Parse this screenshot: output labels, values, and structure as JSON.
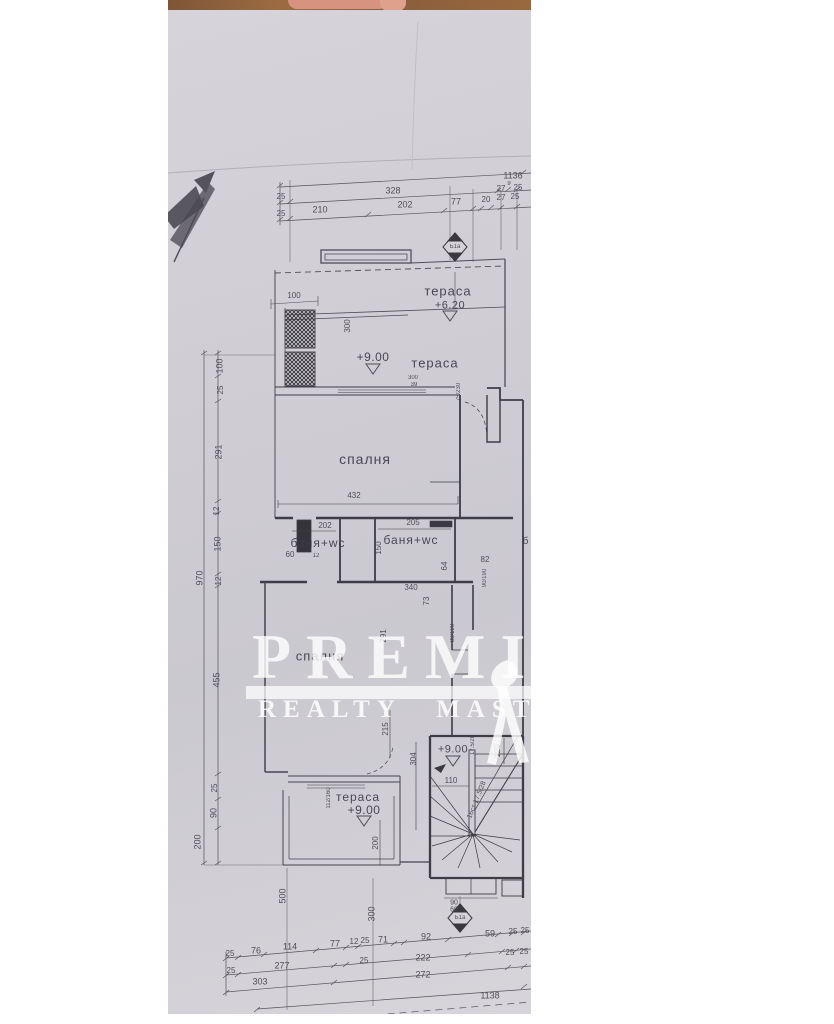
{
  "colors": {
    "page_background": "#ffffff",
    "paper": "#d2d0d6",
    "ink": "#46444c",
    "wall_ink": "#3a3940",
    "table_wood": "#8a5e3b",
    "watermark_white": "#ffffff"
  },
  "watermark": {
    "title": "PREMIE",
    "subtitle": "REALTY MASTER"
  },
  "plan": {
    "room_labels": [
      {
        "t": "тераса",
        "x": 280,
        "y": 281,
        "s": 13
      },
      {
        "t": "тераса",
        "x": 267,
        "y": 353,
        "s": 13
      },
      {
        "t": "спалня",
        "x": 197,
        "y": 449,
        "s": 14
      },
      {
        "t": "баня+wc",
        "x": 150,
        "y": 533,
        "s": 12
      },
      {
        "t": "баня+wc",
        "x": 243,
        "y": 530,
        "s": 12
      },
      {
        "t": "спалня",
        "x": 152,
        "y": 646,
        "s": 13
      },
      {
        "t": "тераса",
        "x": 190,
        "y": 787,
        "s": 12
      },
      {
        "t": "б",
        "x": 358,
        "y": 532,
        "s": 10
      }
    ],
    "level_labels": [
      {
        "t": "+6.20",
        "x": 282,
        "y": 296,
        "s": 11
      },
      {
        "t": "+9.00",
        "x": 205,
        "y": 347,
        "s": 12
      },
      {
        "t": "+9.00",
        "x": 196,
        "y": 800,
        "s": 12
      },
      {
        "t": "+9.00",
        "x": 285,
        "y": 740,
        "s": 11
      }
    ],
    "marker_labels": [
      {
        "t": "Б1а",
        "x": 287,
        "y": 237,
        "s": 6
      },
      {
        "t": "Б1а",
        "x": 292,
        "y": 908,
        "s": 6
      }
    ],
    "dim_labels": [
      {
        "t": "1136",
        "x": 345,
        "y": 166,
        "s": 9
      },
      {
        "t": "25",
        "x": 113,
        "y": 187,
        "s": 8
      },
      {
        "t": "328",
        "x": 225,
        "y": 181,
        "s": 9
      },
      {
        "t": "27",
        "x": 333,
        "y": 179,
        "s": 8
      },
      {
        "t": "9",
        "x": 341,
        "y": 174,
        "s": 6
      },
      {
        "t": "25",
        "x": 350,
        "y": 178,
        "s": 8
      },
      {
        "t": "25",
        "x": 113,
        "y": 204,
        "s": 8
      },
      {
        "t": "210",
        "x": 152,
        "y": 200,
        "s": 9
      },
      {
        "t": "202",
        "x": 237,
        "y": 195,
        "s": 9
      },
      {
        "t": "77",
        "x": 288,
        "y": 192,
        "s": 9
      },
      {
        "t": "20",
        "x": 318,
        "y": 190,
        "s": 8
      },
      {
        "t": "27",
        "x": 333,
        "y": 188,
        "s": 8
      },
      {
        "t": "25",
        "x": 347,
        "y": 187,
        "s": 8
      },
      {
        "t": "100",
        "x": 126,
        "y": 286,
        "s": 8
      },
      {
        "t": "300",
        "x": 180,
        "y": 316,
        "s": 8,
        "r": 1
      },
      {
        "t": "300",
        "x": 245,
        "y": 368,
        "s": 6
      },
      {
        "t": "39",
        "x": 246,
        "y": 375,
        "s": 6
      },
      {
        "t": "75/230",
        "x": 291,
        "y": 382,
        "s": 6,
        "r": 1
      },
      {
        "t": "100",
        "x": 52,
        "y": 356,
        "s": 9,
        "r": 1
      },
      {
        "t": "25",
        "x": 53,
        "y": 380,
        "s": 8,
        "r": 1
      },
      {
        "t": "291",
        "x": 51,
        "y": 442,
        "s": 9,
        "r": 1
      },
      {
        "t": "12",
        "x": 49,
        "y": 501,
        "s": 8,
        "r": 1
      },
      {
        "t": "150",
        "x": 50,
        "y": 534,
        "s": 9,
        "r": 1
      },
      {
        "t": "12",
        "x": 51,
        "y": 571,
        "s": 8,
        "r": 1
      },
      {
        "t": "455",
        "x": 49,
        "y": 670,
        "s": 9,
        "r": 1
      },
      {
        "t": "25",
        "x": 47,
        "y": 778,
        "s": 8,
        "r": 1
      },
      {
        "t": "90",
        "x": 46,
        "y": 803,
        "s": 9,
        "r": 1
      },
      {
        "t": "200",
        "x": 30,
        "y": 832,
        "s": 9,
        "r": 1
      },
      {
        "t": "970",
        "x": 32,
        "y": 568,
        "s": 9,
        "r": 1
      },
      {
        "t": "432",
        "x": 186,
        "y": 486,
        "s": 8
      },
      {
        "t": "202",
        "x": 157,
        "y": 516,
        "s": 8
      },
      {
        "t": "205",
        "x": 245,
        "y": 513,
        "s": 8
      },
      {
        "t": "60",
        "x": 122,
        "y": 545,
        "s": 8
      },
      {
        "t": "12",
        "x": 148,
        "y": 546,
        "s": 6
      },
      {
        "t": "150",
        "x": 211,
        "y": 538,
        "s": 8,
        "r": 1
      },
      {
        "t": "64",
        "x": 277,
        "y": 556,
        "s": 8,
        "r": 1
      },
      {
        "t": "82",
        "x": 317,
        "y": 550,
        "s": 8
      },
      {
        "t": "90/190",
        "x": 317,
        "y": 568,
        "s": 6,
        "r": 1
      },
      {
        "t": "340",
        "x": 243,
        "y": 578,
        "s": 8
      },
      {
        "t": "73",
        "x": 259,
        "y": 591,
        "s": 8,
        "r": 1
      },
      {
        "t": "291",
        "x": 216,
        "y": 626,
        "s": 8,
        "r": 1
      },
      {
        "t": "80/190",
        "x": 285,
        "y": 623,
        "s": 6,
        "r": 1
      },
      {
        "t": "112/160",
        "x": 161,
        "y": 788,
        "s": 6,
        "r": 1
      },
      {
        "t": "215",
        "x": 218,
        "y": 719,
        "s": 8,
        "r": 1
      },
      {
        "t": "200",
        "x": 208,
        "y": 833,
        "s": 8,
        "r": 1
      },
      {
        "t": "110",
        "x": 283,
        "y": 771,
        "s": 8
      },
      {
        "t": "304",
        "x": 246,
        "y": 749,
        "s": 8,
        "r": 1
      },
      {
        "t": "120",
        "x": 330,
        "y": 741,
        "s": 8,
        "r": 1
      },
      {
        "t": "17.5/28",
        "x": 305,
        "y": 735,
        "s": 6,
        "r": 1
      },
      {
        "t": "16ст 17.5/28",
        "x": 309,
        "y": 790,
        "s": 7,
        "r": 2
      },
      {
        "t": "90",
        "x": 286,
        "y": 893,
        "s": 7
      },
      {
        "t": "60",
        "x": 286,
        "y": 900,
        "s": 7
      },
      {
        "t": "500",
        "x": 115,
        "y": 886,
        "s": 9,
        "r": 1
      },
      {
        "t": "300",
        "x": 204,
        "y": 904,
        "s": 9,
        "r": 1
      },
      {
        "t": "25",
        "x": 62,
        "y": 944,
        "s": 8
      },
      {
        "t": "76",
        "x": 88,
        "y": 941,
        "s": 9
      },
      {
        "t": "114",
        "x": 122,
        "y": 937,
        "s": 9
      },
      {
        "t": "77",
        "x": 167,
        "y": 934,
        "s": 9
      },
      {
        "t": "12",
        "x": 186,
        "y": 932,
        "s": 8
      },
      {
        "t": "25",
        "x": 197,
        "y": 931,
        "s": 8
      },
      {
        "t": "71",
        "x": 215,
        "y": 930,
        "s": 9
      },
      {
        "t": "92",
        "x": 258,
        "y": 927,
        "s": 9
      },
      {
        "t": "59",
        "x": 322,
        "y": 924,
        "s": 9
      },
      {
        "t": "25",
        "x": 345,
        "y": 922,
        "s": 8
      },
      {
        "t": "25",
        "x": 357,
        "y": 921,
        "s": 8
      },
      {
        "t": "25",
        "x": 63,
        "y": 961,
        "s": 8
      },
      {
        "t": "277",
        "x": 114,
        "y": 956,
        "s": 9
      },
      {
        "t": "25",
        "x": 196,
        "y": 951,
        "s": 8
      },
      {
        "t": "222",
        "x": 255,
        "y": 948,
        "s": 9
      },
      {
        "t": "25",
        "x": 342,
        "y": 943,
        "s": 8
      },
      {
        "t": "25",
        "x": 356,
        "y": 942,
        "s": 8
      },
      {
        "t": "303",
        "x": 92,
        "y": 972,
        "s": 9
      },
      {
        "t": "272",
        "x": 255,
        "y": 965,
        "s": 9
      },
      {
        "t": "1138",
        "x": 322,
        "y": 986,
        "s": 9
      }
    ]
  }
}
